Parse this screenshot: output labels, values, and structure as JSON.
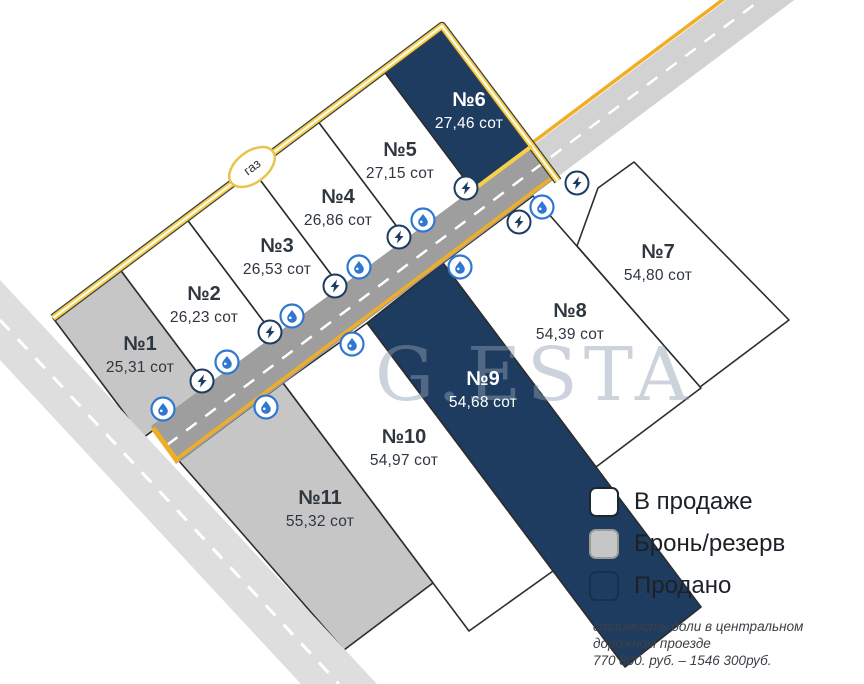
{
  "plots": [
    {
      "number": "№1",
      "area": "25,31 сот",
      "status": "reserved"
    },
    {
      "number": "№2",
      "area": "26,23 сот",
      "status": "available"
    },
    {
      "number": "№3",
      "area": "26,53 сот",
      "status": "available"
    },
    {
      "number": "№4",
      "area": "26,86 сот",
      "status": "available"
    },
    {
      "number": "№5",
      "area": "27,15 сот",
      "status": "available"
    },
    {
      "number": "№6",
      "area": "27,46 сот",
      "status": "sold"
    },
    {
      "number": "№7",
      "area": "54,80 сот",
      "status": "available"
    },
    {
      "number": "№8",
      "area": "54,39 сот",
      "status": "available"
    },
    {
      "number": "№9",
      "area": "54,68 сот",
      "status": "sold"
    },
    {
      "number": "№10",
      "area": "54,97 сот",
      "status": "available"
    },
    {
      "number": "№11",
      "area": "55,32 сот",
      "status": "reserved"
    }
  ],
  "legend": {
    "items": [
      {
        "label": "В продаже",
        "status": "available"
      },
      {
        "label": "Бронь/резерв",
        "status": "reserved"
      },
      {
        "label": "Продано",
        "status": "sold"
      }
    ]
  },
  "note": {
    "lines": [
      "стоимость доли в центральном",
      "дорожном проезде",
      "770 800. руб. – 1546 300руб."
    ]
  },
  "gas_label": "газ",
  "watermark": "G.ESTA",
  "icons": {
    "electricity": "lightning-bolt-in-circle",
    "water": "water-drop-in-circle"
  },
  "colors": {
    "available": "#ffffff",
    "reserved": "#c6c6c6",
    "sold": "#1e3c5f",
    "plot_label": "#2e3640",
    "plot_label_on_sold": "#ffffff",
    "road": "#9e9e9e",
    "road_light": "#d2d2d2",
    "side_road": "#dedede",
    "road_marking_yellow": "#f0ae26",
    "gas_yellow": "#f7cf4b",
    "water_icon": "#2f77d1",
    "electricity_icon": "#1e3c5f",
    "watermark": "#8fa0b2"
  }
}
